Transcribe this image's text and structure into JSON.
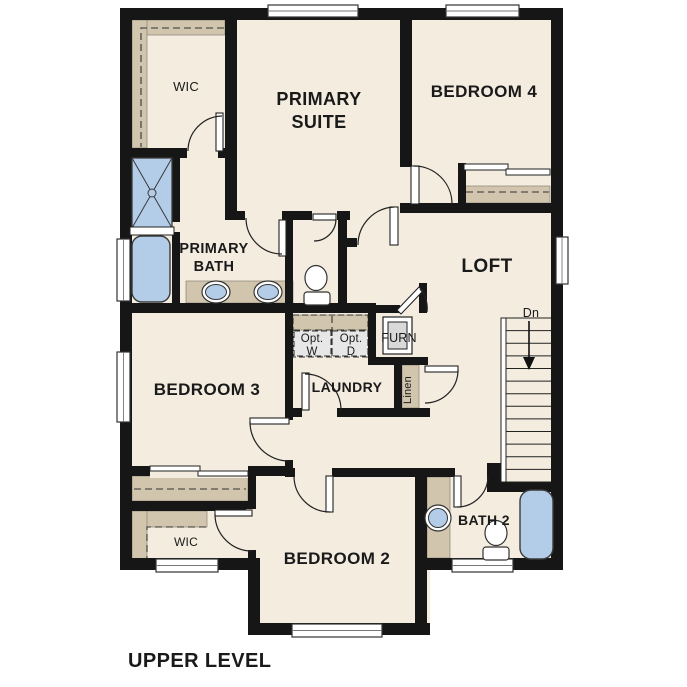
{
  "title": "UPPER LEVEL",
  "colors": {
    "floor": "#f3ecdf",
    "wall": "#161616",
    "shelf_tan": "#d1c5ae",
    "fixture_blue": "#b3cde9",
    "appliance_gray": "#e7e7e7",
    "furnace_gray": "#d9d9d9",
    "line": "#222222"
  },
  "plan": {
    "floors": [
      [
        120,
        8,
        443,
        562
      ],
      [
        248,
        468,
        182,
        167
      ]
    ],
    "walls": [
      [
        120,
        8,
        443,
        12
      ],
      [
        120,
        8,
        12,
        562
      ],
      [
        551,
        8,
        12,
        562
      ],
      [
        120,
        558,
        140,
        12
      ],
      [
        248,
        558,
        12,
        77
      ],
      [
        248,
        623,
        182,
        12
      ],
      [
        415,
        468,
        12,
        167
      ],
      [
        415,
        558,
        148,
        12
      ],
      [
        225,
        16,
        12,
        204
      ],
      [
        126,
        148,
        104,
        10
      ],
      [
        172,
        155,
        8,
        67
      ],
      [
        172,
        232,
        8,
        73
      ],
      [
        126,
        303,
        250,
        10
      ],
      [
        237,
        211,
        113,
        9
      ],
      [
        285,
        220,
        8,
        88
      ],
      [
        338,
        220,
        9,
        88
      ],
      [
        347,
        238,
        10,
        9
      ],
      [
        400,
        8,
        12,
        159
      ],
      [
        400,
        205,
        12,
        8
      ],
      [
        400,
        203,
        163,
        10
      ],
      [
        458,
        163,
        8,
        40
      ],
      [
        285,
        303,
        8,
        167
      ],
      [
        368,
        308,
        8,
        57
      ],
      [
        376,
        305,
        24,
        8
      ],
      [
        419,
        283,
        8,
        30
      ],
      [
        368,
        357,
        60,
        8
      ],
      [
        394,
        365,
        8,
        43
      ],
      [
        394,
        408,
        36,
        9
      ],
      [
        293,
        408,
        107,
        9
      ],
      [
        285,
        468,
        170,
        9
      ],
      [
        487,
        463,
        14,
        29
      ],
      [
        501,
        482,
        62,
        10
      ],
      [
        126,
        466,
        167,
        10
      ],
      [
        248,
        466,
        8,
        97
      ],
      [
        126,
        501,
        130,
        10
      ]
    ],
    "door_openings": [
      [
        187,
        146,
        31,
        14
      ],
      [
        245,
        209,
        37,
        13
      ],
      [
        312,
        209,
        25,
        13
      ],
      [
        283,
        420,
        12,
        40
      ],
      [
        302,
        406,
        35,
        13
      ],
      [
        295,
        466,
        37,
        13
      ],
      [
        150,
        464,
        98,
        14
      ],
      [
        246,
        509,
        12,
        41
      ]
    ],
    "windows": [
      [
        268,
        5,
        90,
        12
      ],
      [
        446,
        5,
        73,
        12
      ],
      [
        117,
        239,
        13,
        62
      ],
      [
        117,
        352,
        13,
        70
      ],
      [
        556,
        237,
        12,
        47
      ],
      [
        156,
        559,
        62,
        13
      ],
      [
        452,
        559,
        61,
        13
      ],
      [
        292,
        624,
        90,
        13
      ]
    ],
    "shelf_areas": [
      [
        132,
        20,
        93,
        15
      ],
      [
        132,
        20,
        15,
        128
      ],
      [
        464,
        186,
        86,
        17
      ],
      [
        186,
        281,
        107,
        22
      ],
      [
        293,
        315,
        75,
        15
      ],
      [
        402,
        365,
        17,
        43
      ],
      [
        132,
        476,
        116,
        25
      ],
      [
        132,
        511,
        75,
        16
      ],
      [
        132,
        511,
        15,
        52
      ],
      [
        427,
        477,
        23,
        81
      ]
    ],
    "dash_rects": [
      [
        293,
        315,
        75,
        42
      ],
      [
        294,
        331,
        37,
        25
      ],
      [
        332,
        331,
        36,
        25
      ]
    ],
    "optional_units": [
      [
        294,
        331,
        37,
        25
      ],
      [
        332,
        331,
        36,
        25
      ]
    ],
    "dashes": [
      "M224,28 H141 V147",
      "M466,192 H549",
      "M293,330 H368",
      "M332,316 V356",
      "M134,489 H246",
      "M206,527 H147 V561"
    ],
    "closet_panels": [
      [
        150,
        466,
        50,
        5
      ],
      [
        198,
        471,
        50,
        5
      ],
      [
        464,
        164,
        44,
        6
      ],
      [
        506,
        169,
        44,
        6
      ]
    ],
    "door_leaves": [
      [
        216,
        113,
        7,
        38
      ],
      [
        279,
        220,
        7,
        36
      ],
      [
        313,
        214,
        23,
        6
      ],
      [
        390,
        207,
        8,
        38
      ],
      [
        411,
        166,
        8,
        38
      ],
      [
        302,
        373,
        7,
        37
      ],
      [
        425,
        366,
        33,
        6
      ],
      [
        250,
        418,
        39,
        6
      ],
      [
        326,
        476,
        7,
        36
      ],
      [
        454,
        476,
        7,
        31
      ],
      [
        215,
        510,
        37,
        6
      ]
    ],
    "furn_door_leaf": [
      [
        397,
        310
      ],
      [
        419,
        287
      ],
      [
        423,
        291
      ],
      [
        401,
        314
      ]
    ],
    "door_arcs": [
      "M188,151 A35 35 0 0 1 222,116",
      "M246,218 A36 36 0 0 0 282,254",
      "M336,219 A22 22 0 0 1 314,241",
      "M358,245 A38 38 0 0 1 394,207",
      "M414,166 A38 38 0 0 1 452,204",
      "M305,374 A36 36 0 0 1 341,410",
      "M458,370 A33 33 0 0 1 425,403",
      "M250,422 A39 39 0 0 0 289,461",
      "M294,476 A36 36 0 0 0 330,512",
      "M488,476 A31 31 0 0 1 457,507",
      "M215,514 A37 37 0 0 0 252,551",
      "M420,289 A30 30 0 0 1 427,312"
    ],
    "shower": {
      "x": 132,
      "y": 158,
      "w": 40,
      "h": 70
    },
    "shower_shelf": [
      130,
      227,
      44,
      8
    ],
    "tubs": [
      {
        "x": 132,
        "y": 236,
        "w": 38,
        "h": 66,
        "rx": 10
      },
      {
        "x": 520,
        "y": 490,
        "w": 33,
        "h": 69,
        "rx": 11
      }
    ],
    "oval_sinks": [
      {
        "cx": 216,
        "cy": 292
      },
      {
        "cx": 268,
        "cy": 292
      }
    ],
    "round_sinks": [
      {
        "cx": 438,
        "cy": 518
      }
    ],
    "toilets": [
      {
        "cx": 316,
        "cy": 278,
        "tx": 304,
        "ty": 292
      },
      {
        "cx": 496,
        "cy": 533,
        "tx": 483,
        "ty": 547
      }
    ],
    "furnace_unit": {
      "outer": [
        383,
        317,
        29,
        37
      ],
      "inner": [
        388,
        322,
        19,
        27
      ]
    },
    "stairs": {
      "stringer": [
        501,
        318,
        5,
        164
      ],
      "tread_x1": 506,
      "tread_x2": 551,
      "y_top": 318,
      "y_bottom": 482,
      "treads": 13,
      "arrow_line": [
        529,
        321,
        529,
        358
      ],
      "arrow_head": [
        [
          523,
          357
        ],
        [
          535,
          357
        ],
        [
          529,
          370
        ]
      ]
    }
  },
  "labels": [
    {
      "name": "room-label-wic-primary",
      "text": "WIC",
      "x": 186,
      "y": 91,
      "s": 13,
      "w": 500
    },
    {
      "name": "room-label-primary-suite-line1",
      "text": "PRIMARY",
      "x": 319,
      "y": 105,
      "s": 18,
      "w": 700
    },
    {
      "name": "room-label-primary-suite-line2",
      "text": "SUITE",
      "x": 319,
      "y": 128,
      "s": 18,
      "w": 700
    },
    {
      "name": "room-label-bedroom-4",
      "text": "BEDROOM 4",
      "x": 484,
      "y": 97,
      "s": 17,
      "w": 700
    },
    {
      "name": "room-label-primary-bath-line1",
      "text": "PRIMARY",
      "x": 214,
      "y": 253,
      "s": 14.5,
      "w": 700
    },
    {
      "name": "room-label-primary-bath-line2",
      "text": "BATH",
      "x": 214,
      "y": 271,
      "s": 14.5,
      "w": 700
    },
    {
      "name": "room-label-loft",
      "text": "LOFT",
      "x": 487,
      "y": 272,
      "s": 19,
      "w": 700
    },
    {
      "name": "stairs-direction-label",
      "text": "Dn",
      "x": 531,
      "y": 317,
      "s": 12.5,
      "w": 500
    },
    {
      "name": "label-opt-washer-line1",
      "text": "Opt.",
      "x": 312,
      "y": 342,
      "s": 11.5,
      "w": 400
    },
    {
      "name": "label-opt-washer-line2",
      "text": "W",
      "x": 312,
      "y": 355,
      "s": 11.5,
      "w": 400
    },
    {
      "name": "label-opt-dryer-line1",
      "text": "Opt.",
      "x": 351,
      "y": 342,
      "s": 11.5,
      "w": 400
    },
    {
      "name": "label-opt-dryer-line2",
      "text": "D",
      "x": 351,
      "y": 355,
      "s": 11.5,
      "w": 400
    },
    {
      "name": "room-label-furnace",
      "text": "FURN",
      "x": 399,
      "y": 342,
      "s": 12.5,
      "w": 500
    },
    {
      "name": "room-label-linen",
      "text": "Linen",
      "x": 411,
      "y": 390,
      "s": 11,
      "w": 400,
      "rot": -90
    },
    {
      "name": "room-label-bedroom-3",
      "text": "BEDROOM 3",
      "x": 207,
      "y": 395,
      "s": 17,
      "w": 700
    },
    {
      "name": "room-label-laundry",
      "text": "LAUNDRY",
      "x": 347,
      "y": 392,
      "s": 14,
      "w": 700
    },
    {
      "name": "room-label-bath-2",
      "text": "BATH 2",
      "x": 484,
      "y": 525,
      "s": 14,
      "w": 700
    },
    {
      "name": "room-label-bedroom-2",
      "text": "BEDROOM 2",
      "x": 337,
      "y": 564,
      "s": 17,
      "w": 700
    },
    {
      "name": "room-label-wic-bedroom2",
      "text": "WIC",
      "x": 186,
      "y": 546,
      "s": 12,
      "w": 500
    },
    {
      "name": "plan-title",
      "text": "UPPER LEVEL",
      "x": 128,
      "y": 667,
      "s": 20,
      "w": 700,
      "anchor": "start"
    }
  ]
}
